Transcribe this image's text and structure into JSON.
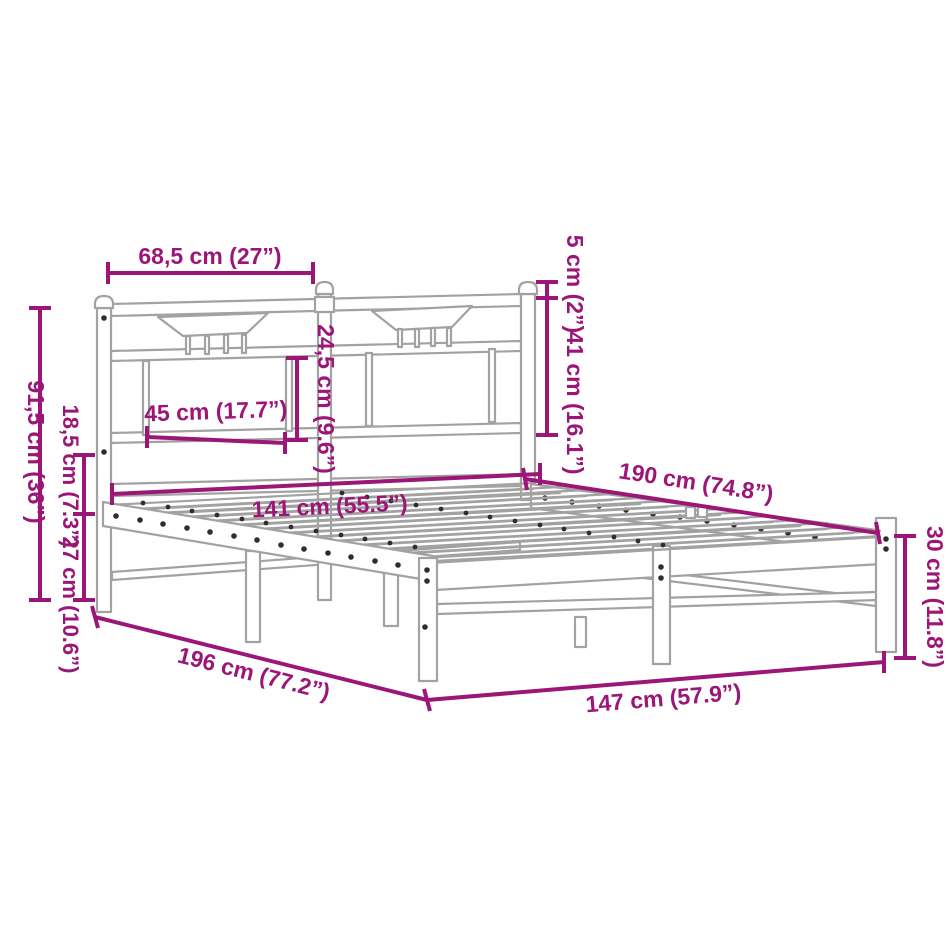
{
  "page": {
    "background": "#ffffff",
    "description_labels_language": "metric + inches"
  },
  "colors": {
    "dimension_magenta": "#9c1677",
    "drawing_gray": "#a2a2a2",
    "screw_dot_dark": "#2e2e2e",
    "background": "#ffffff"
  },
  "dimensions": {
    "headboard_section_width": {
      "label": "68,5 cm (27”)"
    },
    "post_above_rail": {
      "label": "5 cm (2”)"
    },
    "headboard_rail_height": {
      "label": "41 cm (16.1”)"
    },
    "panel_gap_height": {
      "label": "24,5 cm (9.6”)"
    },
    "panel_width": {
      "label": "45 cm (17.7”)"
    },
    "headboard_height": {
      "label": "91,5 cm (36”)"
    },
    "rail_to_base": {
      "label": "18,5 cm (7.3”)"
    },
    "base_height": {
      "label": "27 cm (10.6”)"
    },
    "inner_length": {
      "label": "190 cm (74.8”)"
    },
    "inner_width": {
      "label": "141 cm (55.5”)"
    },
    "overall_length": {
      "label": "196 cm (77.2”)"
    },
    "overall_width": {
      "label": "147 cm (57.9”)"
    },
    "foot_height": {
      "label": "30 cm (11.8”)"
    }
  }
}
